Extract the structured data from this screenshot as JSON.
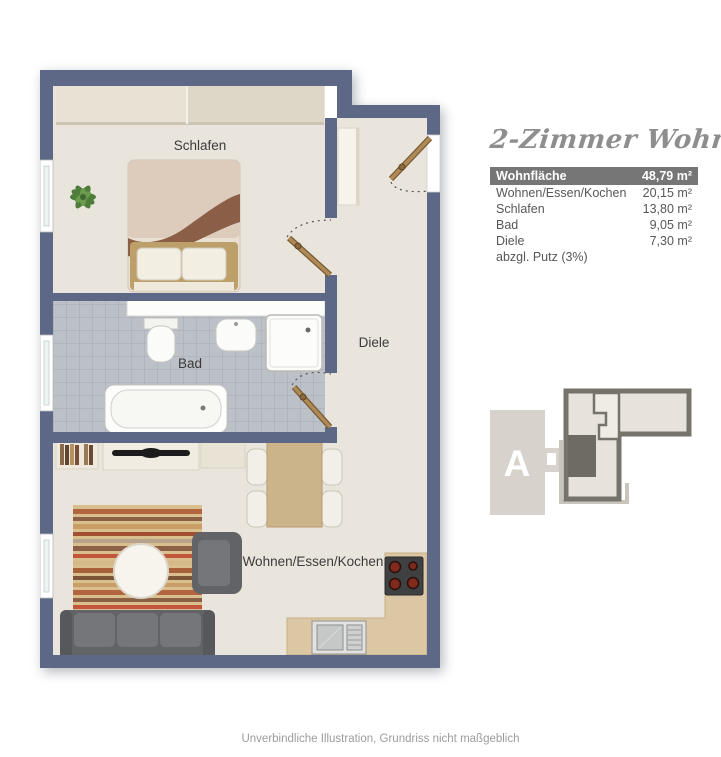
{
  "plan": {
    "rooms": {
      "schlafen_label": "Schlafen",
      "bad_label": "Bad",
      "diele_label": "Diele",
      "wohnen_label": "Wohnen/Essen/Kochen"
    }
  },
  "info_panel": {
    "title": "2-Zimmer Wohnung",
    "area_table": {
      "header": {
        "label": "Wohnfläche",
        "value": "48,79 m²"
      },
      "rows": [
        {
          "label": "Wohnen/Essen/Kochen",
          "value": "20,15 m²"
        },
        {
          "label": "Schlafen",
          "value": "13,80 m²"
        },
        {
          "label": "Bad",
          "value": "9,05 m²"
        },
        {
          "label": "Diele",
          "value": "7,30 m²"
        },
        {
          "label": "abzgl. Putz (3%)",
          "value": ""
        }
      ]
    },
    "building_locator": {
      "building_label": "A"
    }
  },
  "footer": {
    "disclaimer": "Unverbindliche Illustration, Grundriss nicht maßgeblich"
  },
  "theme": {
    "wall": "#5c6885",
    "floor": "#eae5dc",
    "bath_tile": "#bcc0c7",
    "bath_tile_line": "#a6acb6",
    "table_header_bg": "#767676",
    "table_header_text": "#ffffff",
    "table_text": "#575757",
    "title_text": "#8e8e8e",
    "disclaimer_text": "#9c9c9c",
    "locator_outline": "#76736b",
    "locator_fill": "#d7d3cc",
    "locator_unit_fill": "#6e6b63"
  }
}
